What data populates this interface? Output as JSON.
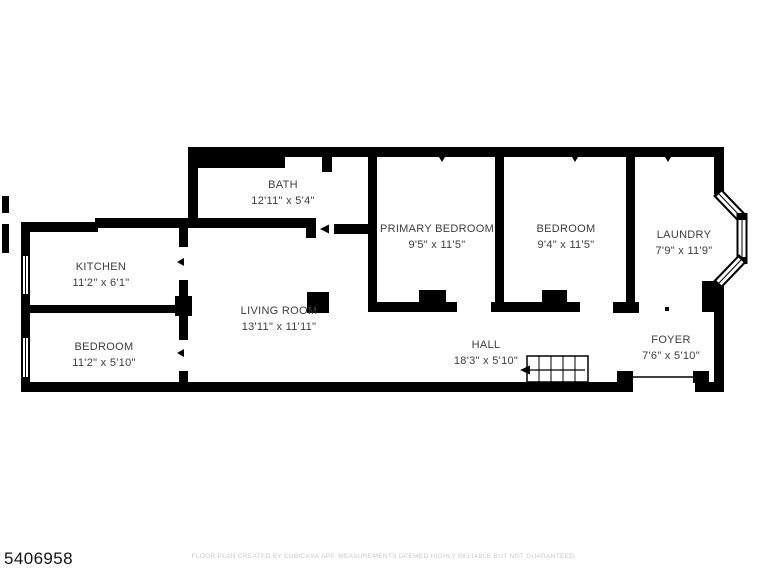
{
  "floor_plan": {
    "id_label": "5406958",
    "disclaimer": "FLOOR PLAN CREATED BY CUBICASA APP. MEASUREMENTS DEEMED HIGHLY RELIABLE BUT NOT GUARANTEED.",
    "rooms": [
      {
        "name": "BATH",
        "dimensions": "12'11\" x 5'4\""
      },
      {
        "name": "KITCHEN",
        "dimensions": "11'2\" x 6'1\""
      },
      {
        "name": "BEDROOM",
        "dimensions": "11'2\" x 5'10\""
      },
      {
        "name": "LIVING ROOM",
        "dimensions": "13'11\" x 11'11\""
      },
      {
        "name": "PRIMARY BEDROOM",
        "dimensions": "9'5\" x 11'5\""
      },
      {
        "name": "BEDROOM",
        "dimensions": "9'4\" x 11'5\""
      },
      {
        "name": "LAUNDRY",
        "dimensions": "7'9\" x 11'9\""
      },
      {
        "name": "HALL",
        "dimensions": "18'3\" x 5'10\""
      },
      {
        "name": "FOYER",
        "dimensions": "7'6\" x 5'10\""
      }
    ],
    "features": {
      "stairs": "staircase-with-direction-arrow",
      "bay_window": "angled-bay-window",
      "entry_door": "foyer-front-entry"
    },
    "colors": {
      "wall": "#000000",
      "room_text": "#3d3d3d",
      "id_text": "#121212",
      "disclaimer_text": "#c9c9c9",
      "background": "#ffffff"
    }
  }
}
